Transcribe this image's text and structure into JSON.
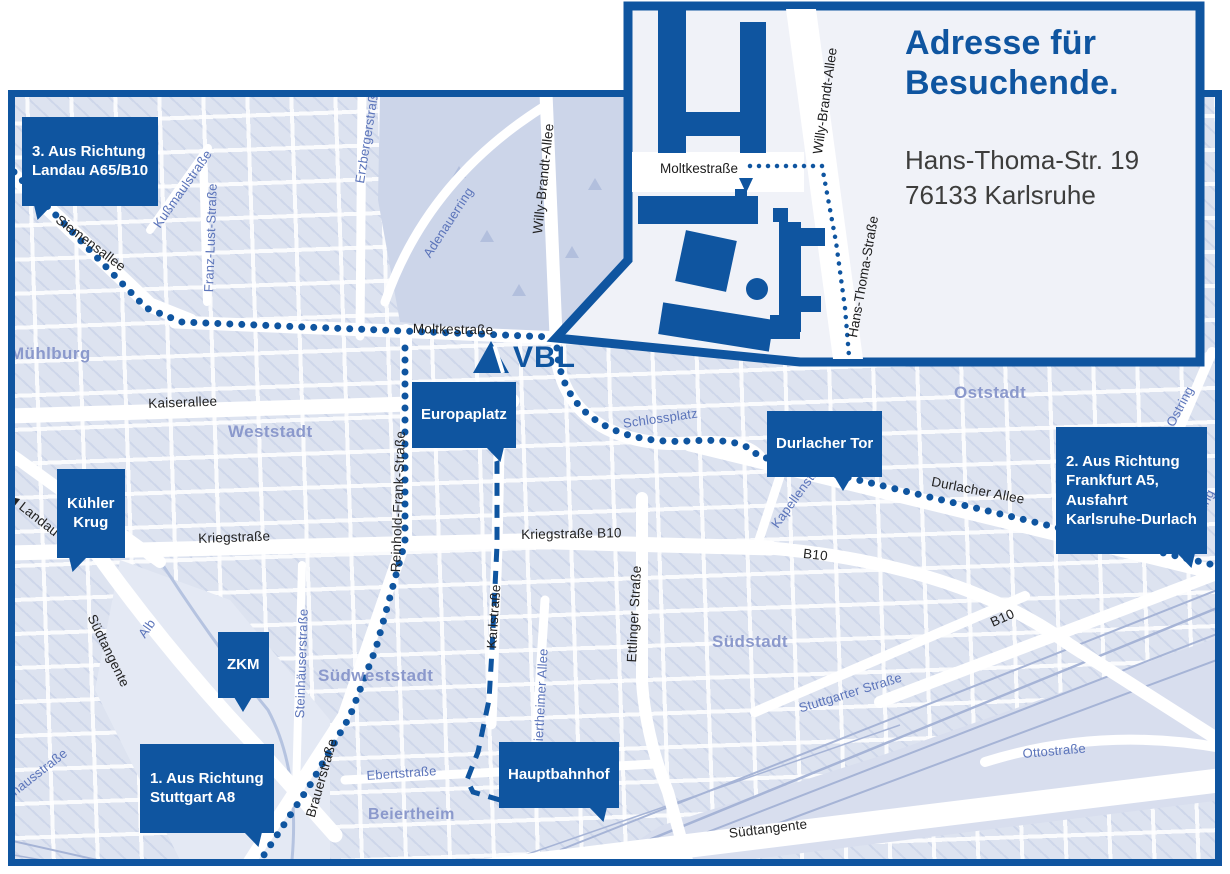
{
  "inset": {
    "title": "Adresse für\nBesuchende.",
    "address": "Hans-Thoma-Str. 19\n76133 Karlsruhe",
    "streets": {
      "moltkestrasse": "Moltkestraße",
      "willy_brandt": "Willy-Brandt-Allee",
      "hans_thoma": "Hans-Thoma-Straße"
    }
  },
  "logo_text": "VBL",
  "callouts": {
    "route3": "3. Aus Richtung\nLandau A65/B10",
    "kuehler_krug": "Kühler\nKrug",
    "zkm": "ZKM",
    "route1": "1. Aus Richtung\nStuttgart A8",
    "europaplatz": "Europaplatz",
    "durlacher_tor": "Durlacher Tor",
    "route2": "2. Aus Richtung\nFrankfurt A5,\nAusfahrt\nKarlsruhe-Durlach",
    "hauptbahnhof": "Hauptbahnhof"
  },
  "streets_black": [
    "Siemensallee",
    "Kaiserallee",
    "Moltkestraße",
    "Kriegstraße",
    "Kriegstraße B10",
    "Karlstraße",
    "Reinhold-Frank-Straße",
    "Brauerstraße",
    "Südtangente",
    "Südtangente",
    "Durlacher Allee",
    "B10",
    "B10",
    "Ettlinger Straße",
    "Willy-Brandt-Allee",
    "◀ Landau B10"
  ],
  "streets_blue": [
    "Kußmaulstraße",
    "Franz-Lust-Straße",
    "Erzbergerstraße",
    "Adenauerring",
    "Schlossplatz",
    "Kapellenstraße",
    "Ostring",
    "Ostring",
    "Stuttgarter Straße",
    "Ottostraße",
    "Steinhäuserstraße",
    "Alb",
    "Beiertheimer Allee",
    "Ebertstraße",
    "Pulverhausstraße"
  ],
  "districts": [
    "Mühlburg",
    "Weststadt",
    "Oststadt",
    "Südstadt",
    "Südweststadt",
    "Beiertheim"
  ],
  "colors": {
    "brand_blue": "#0f55a0",
    "street_blue": "#5b74ba",
    "district_blue": "#8b99cc",
    "label_black": "#222222"
  }
}
